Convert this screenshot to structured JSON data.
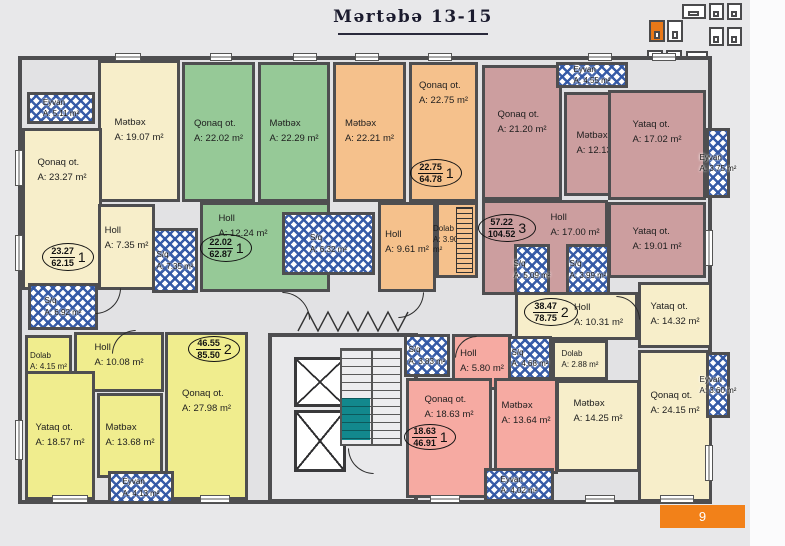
{
  "title": "Mərtəbə 13-15",
  "page_badge": "9",
  "colors": {
    "background": "#e8e8ea",
    "wall": "#4e4e50",
    "cream": "#f7eeca",
    "green": "#96c997",
    "orange": "#f5c18c",
    "mauve": "#cc9e9f",
    "yellow": "#f0ed8e",
    "pink": "#f6aaa2",
    "hatch_blue": "#2f55a4",
    "stairs_teal": "#12888d",
    "accent_orange": "#f28119"
  },
  "minimap": {
    "blocks": [
      {
        "x": 682,
        "y": 4,
        "w": 24,
        "h": 15,
        "active": false
      },
      {
        "x": 709,
        "y": 3,
        "w": 15,
        "h": 17,
        "active": false
      },
      {
        "x": 727,
        "y": 3,
        "w": 15,
        "h": 17,
        "active": false
      },
      {
        "x": 709,
        "y": 27,
        "w": 15,
        "h": 19,
        "active": false
      },
      {
        "x": 727,
        "y": 27,
        "w": 15,
        "h": 19,
        "active": false
      },
      {
        "x": 649,
        "y": 20,
        "w": 16,
        "h": 22,
        "active": true
      },
      {
        "x": 667,
        "y": 20,
        "w": 16,
        "h": 22,
        "active": false
      },
      {
        "x": 647,
        "y": 50,
        "w": 16,
        "h": 17,
        "active": false
      },
      {
        "x": 666,
        "y": 50,
        "w": 16,
        "h": 17,
        "active": false
      },
      {
        "x": 686,
        "y": 51,
        "w": 22,
        "h": 14,
        "active": false
      }
    ]
  },
  "plan": {
    "rooms": [
      {
        "name": "Mətbəx",
        "area": "A: 19.07 m²",
        "fill": "cream",
        "x": 98,
        "y": 60,
        "w": 82,
        "h": 142
      },
      {
        "name": "Qonaq ot.",
        "area": "A: 23.27 m²",
        "fill": "cream",
        "x": 22,
        "y": 128,
        "w": 80,
        "h": 162,
        "dy": -38
      },
      {
        "name": "Holl",
        "area": "A: 7.35 m²",
        "fill": "cream",
        "x": 98,
        "y": 204,
        "w": 57,
        "h": 86,
        "dy": -8
      },
      {
        "name": "Qonaq ot.",
        "area": "A: 22.02 m²",
        "fill": "green",
        "x": 182,
        "y": 62,
        "w": 73,
        "h": 140
      },
      {
        "name": "Mətbəx",
        "area": "A: 22.29 m²",
        "fill": "green",
        "x": 258,
        "y": 62,
        "w": 72,
        "h": 140
      },
      {
        "name": "Holl",
        "area": "A: 12.24 m²",
        "fill": "green",
        "x": 200,
        "y": 202,
        "w": 130,
        "h": 90,
        "dx": -22,
        "dy": -20
      },
      {
        "name": "Mətbəx",
        "area": "A: 22.21 m²",
        "fill": "orange",
        "x": 333,
        "y": 62,
        "w": 73,
        "h": 140
      },
      {
        "name": "Qonaq ot.",
        "area": "A: 22.75 m²",
        "fill": "orange",
        "x": 409,
        "y": 62,
        "w": 69,
        "h": 140,
        "dy": -38
      },
      {
        "name": "Holl",
        "area": "A: 9.61 m²",
        "fill": "orange",
        "x": 378,
        "y": 202,
        "w": 58,
        "h": 90,
        "dy": -4
      },
      {
        "name": "Dolab",
        "area": "A: 3.90 m²",
        "fill": "orange",
        "x": 436,
        "y": 202,
        "w": 42,
        "h": 76,
        "small": true,
        "shelf": true,
        "dx": -6
      },
      {
        "name": "Qonaq ot.",
        "area": "A: 21.20 m²",
        "fill": "mauve",
        "x": 482,
        "y": 65,
        "w": 80,
        "h": 135,
        "dy": -10
      },
      {
        "name": "Mətbəx",
        "area": "A: 12.13 m²",
        "fill": "mauve",
        "x": 564,
        "y": 92,
        "w": 74,
        "h": 104
      },
      {
        "name": "Holl",
        "area": "A: 17.00 m²",
        "fill": "mauve",
        "x": 482,
        "y": 200,
        "w": 126,
        "h": 95,
        "dx": 30,
        "dy": -22
      },
      {
        "name": "Yataq ot.",
        "area": "A: 17.02 m²",
        "fill": "mauve",
        "x": 608,
        "y": 90,
        "w": 98,
        "h": 110,
        "dy": -12
      },
      {
        "name": "Yataq ot.",
        "area": "A: 19.01 m²",
        "fill": "mauve",
        "x": 608,
        "y": 202,
        "w": 98,
        "h": 76
      },
      {
        "name": "Holl",
        "area": "A: 10.31 m²",
        "fill": "cream",
        "x": 515,
        "y": 292,
        "w": 123,
        "h": 48,
        "dx": 22
      },
      {
        "name": "Dolab",
        "area": "A: 2.88 m²",
        "fill": "cream",
        "x": 552,
        "y": 340,
        "w": 56,
        "h": 40,
        "small": true
      },
      {
        "name": "Mətbəx",
        "area": "A: 14.25 m²",
        "fill": "cream",
        "x": 556,
        "y": 380,
        "w": 84,
        "h": 92,
        "dy": -14
      },
      {
        "name": "Yataq ot.",
        "area": "A: 14.32 m²",
        "fill": "cream",
        "x": 638,
        "y": 282,
        "w": 74,
        "h": 66
      },
      {
        "name": "Qonaq ot.",
        "area": "A: 24.15 m²",
        "fill": "cream",
        "x": 638,
        "y": 350,
        "w": 74,
        "h": 152,
        "dy": -22
      },
      {
        "name": "Holl",
        "area": "A: 5.80 m²",
        "fill": "pink",
        "x": 452,
        "y": 334,
        "w": 60,
        "h": 56
      },
      {
        "name": "Qonaq ot.",
        "area": "A: 18.63 m²",
        "fill": "pink",
        "x": 406,
        "y": 378,
        "w": 86,
        "h": 120,
        "dy": -30
      },
      {
        "name": "Mətbəx",
        "area": "A: 13.64 m²",
        "fill": "pink",
        "x": 494,
        "y": 378,
        "w": 64,
        "h": 96,
        "dy": -12
      },
      {
        "name": "Dolab",
        "area": "A: 4.15 m²",
        "fill": "yellow",
        "x": 25,
        "y": 335,
        "w": 47,
        "h": 54,
        "small": true
      },
      {
        "name": "Holl",
        "area": "A: 10.08 m²",
        "fill": "yellow",
        "x": 74,
        "y": 332,
        "w": 90,
        "h": 60,
        "dy": -6
      },
      {
        "name": "Yataq ot.",
        "area": "A: 18.57 m²",
        "fill": "yellow",
        "x": 25,
        "y": 371,
        "w": 70,
        "h": 129
      },
      {
        "name": "Mətbəx",
        "area": "A: 13.68 m²",
        "fill": "yellow",
        "x": 97,
        "y": 393,
        "w": 66,
        "h": 85
      },
      {
        "name": "Qonaq ot.",
        "area": "A: 27.98 m²",
        "fill": "yellow",
        "x": 165,
        "y": 332,
        "w": 83,
        "h": 168,
        "dy": -14
      }
    ],
    "wet_areas": [
      {
        "label": "Eyvan",
        "area": "A: 5.11 m²",
        "x": 27,
        "y": 92,
        "w": 68,
        "h": 32
      },
      {
        "label": "S/q",
        "area": "A: 6.92 m²",
        "x": 28,
        "y": 283,
        "w": 70,
        "h": 47
      },
      {
        "label": "S/q",
        "area": "A: 7.35 m²",
        "x": 152,
        "y": 228,
        "w": 46,
        "h": 65
      },
      {
        "label": "S/q",
        "area": "A: 6.32 m²",
        "x": 282,
        "y": 212,
        "w": 93,
        "h": 63
      },
      {
        "label": "Eyvan",
        "area": "A: 4.55 m²",
        "x": 556,
        "y": 62,
        "w": 72,
        "h": 26
      },
      {
        "label": "S/q",
        "area": "A: 5.09 m²",
        "x": 514,
        "y": 244,
        "w": 36,
        "h": 51
      },
      {
        "label": "S/q",
        "area": "A: 3.99 m²",
        "x": 566,
        "y": 244,
        "w": 44,
        "h": 51
      },
      {
        "label": "Eyvan",
        "area": "A: 3.75 m²",
        "x": 706,
        "y": 128,
        "w": 24,
        "h": 70
      },
      {
        "label": "Eyvan",
        "area": "A: 3.60 m²",
        "x": 706,
        "y": 352,
        "w": 24,
        "h": 66
      },
      {
        "label": "S/q",
        "area": "A: 4.68 m²",
        "x": 508,
        "y": 336,
        "w": 44,
        "h": 44
      },
      {
        "label": "S/q",
        "area": "A: 3.83 m²",
        "x": 404,
        "y": 334,
        "w": 46,
        "h": 43
      },
      {
        "label": "Eyvan",
        "area": "A: 4.02 m²",
        "x": 484,
        "y": 468,
        "w": 70,
        "h": 34
      },
      {
        "label": "Eyvan",
        "area": "A: 4.13 m²",
        "x": 108,
        "y": 471,
        "w": 66,
        "h": 33
      }
    ],
    "unit_badges": [
      {
        "living": "23.27",
        "total": "62.15",
        "count": "1",
        "x": 42,
        "y": 243,
        "w": 52,
        "h": 28
      },
      {
        "living": "22.02",
        "total": "62.87",
        "count": "1",
        "x": 200,
        "y": 234,
        "w": 52,
        "h": 28
      },
      {
        "living": "22.75",
        "total": "64.78",
        "count": "1",
        "x": 410,
        "y": 159,
        "w": 52,
        "h": 28
      },
      {
        "living": "57.22",
        "total": "104.52",
        "count": "3",
        "x": 478,
        "y": 214,
        "w": 58,
        "h": 28
      },
      {
        "living": "38.47",
        "total": "78.75",
        "count": "2",
        "x": 524,
        "y": 298,
        "w": 54,
        "h": 28
      },
      {
        "living": "46.55",
        "total": "85.50",
        "count": "2",
        "x": 188,
        "y": 336,
        "w": 52,
        "h": 26
      },
      {
        "living": "18.63",
        "total": "46.91",
        "count": "1",
        "x": 404,
        "y": 424,
        "w": 52,
        "h": 26
      }
    ],
    "windows": [
      {
        "x": 115,
        "y": 53,
        "w": 26,
        "h": 8,
        "o": "h"
      },
      {
        "x": 210,
        "y": 53,
        "w": 22,
        "h": 8,
        "o": "h"
      },
      {
        "x": 293,
        "y": 53,
        "w": 24,
        "h": 8,
        "o": "h"
      },
      {
        "x": 355,
        "y": 53,
        "w": 24,
        "h": 8,
        "o": "h"
      },
      {
        "x": 428,
        "y": 53,
        "w": 24,
        "h": 8,
        "o": "h"
      },
      {
        "x": 588,
        "y": 53,
        "w": 24,
        "h": 8,
        "o": "h"
      },
      {
        "x": 652,
        "y": 53,
        "w": 24,
        "h": 8,
        "o": "h"
      },
      {
        "x": 52,
        "y": 495,
        "w": 36,
        "h": 8,
        "o": "h"
      },
      {
        "x": 200,
        "y": 495,
        "w": 30,
        "h": 8,
        "o": "h"
      },
      {
        "x": 430,
        "y": 495,
        "w": 30,
        "h": 8,
        "o": "h"
      },
      {
        "x": 585,
        "y": 495,
        "w": 30,
        "h": 8,
        "o": "h"
      },
      {
        "x": 660,
        "y": 495,
        "w": 34,
        "h": 8,
        "o": "h"
      },
      {
        "x": 15,
        "y": 150,
        "w": 8,
        "h": 36,
        "o": "v"
      },
      {
        "x": 15,
        "y": 235,
        "w": 8,
        "h": 36,
        "o": "v"
      },
      {
        "x": 15,
        "y": 420,
        "w": 8,
        "h": 40,
        "o": "v"
      },
      {
        "x": 705,
        "y": 230,
        "w": 8,
        "h": 36,
        "o": "v"
      },
      {
        "x": 705,
        "y": 445,
        "w": 8,
        "h": 36,
        "o": "v"
      }
    ],
    "doors": [
      {
        "x": 95,
        "y": 288,
        "s": 26,
        "rot": 270
      },
      {
        "x": 282,
        "y": 292,
        "s": 28,
        "rot": 180
      },
      {
        "x": 398,
        "y": 292,
        "s": 26,
        "rot": 270
      },
      {
        "x": 455,
        "y": 336,
        "s": 22,
        "rot": 90
      },
      {
        "x": 112,
        "y": 330,
        "s": 24,
        "rot": 90
      },
      {
        "x": 616,
        "y": 296,
        "s": 24,
        "rot": 180
      },
      {
        "x": 348,
        "y": 448,
        "s": 26,
        "rot": 0
      }
    ]
  }
}
